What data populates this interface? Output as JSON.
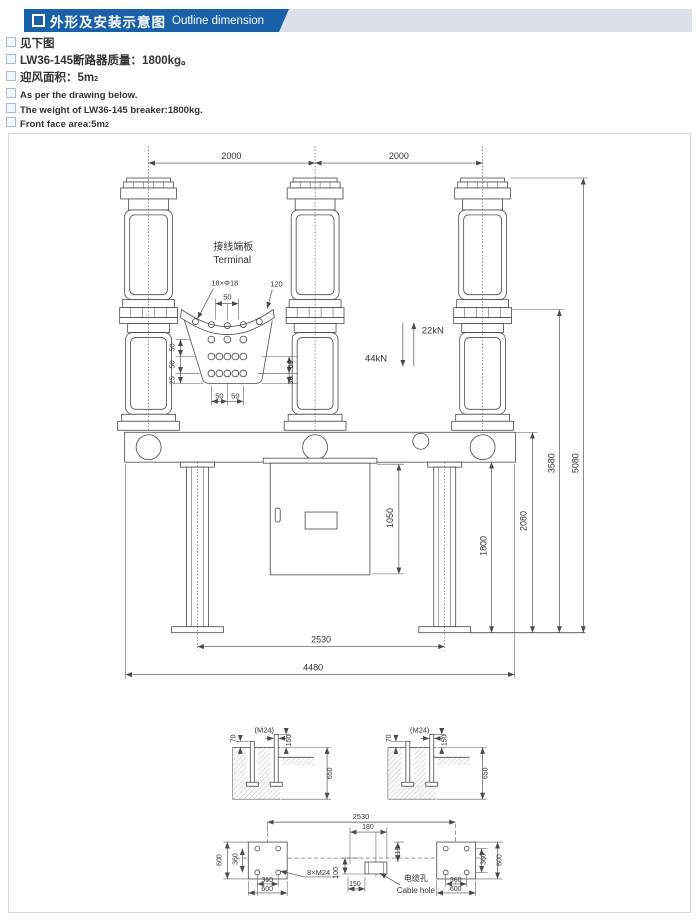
{
  "header": {
    "marker": "square-bullet",
    "title_zh": "外形及安装示意图",
    "title_en": "Outline dimension",
    "banner_color": "#1961a8",
    "band_color": "#dde2ea"
  },
  "bullets": [
    {
      "lang": "zh",
      "text": "见下图",
      "sup": ""
    },
    {
      "lang": "zh",
      "text": "LW36-145断路器质量：1800kg。",
      "sup": ""
    },
    {
      "lang": "zh",
      "text": "迎风面积：5m",
      "sup": "2"
    },
    {
      "lang": "en",
      "text": "As per the drawing below.",
      "sup": ""
    },
    {
      "lang": "en",
      "text": "The weight of LW36-145 breaker:1800kg.",
      "sup": ""
    },
    {
      "lang": "en",
      "text": "Front face area:5m",
      "sup": "2"
    }
  ],
  "drawing": {
    "line_color": "#4a4a4a",
    "labels": [
      {
        "name": "dim-2000-left",
        "text": "2000",
        "x": 223,
        "y": 25,
        "size": 9
      },
      {
        "name": "dim-2000-right",
        "text": "2000",
        "x": 391,
        "y": 25,
        "size": 9
      },
      {
        "name": "force-22kn",
        "text": "22kN",
        "x": 414,
        "y": 200,
        "anchor": "start",
        "size": 9.5
      },
      {
        "name": "force-44kn",
        "text": "44kN",
        "x": 357,
        "y": 228,
        "anchor": "start",
        "size": 9.5
      },
      {
        "name": "terminal-label-zh",
        "text": "接线端板",
        "x": 205,
        "y": 116,
        "anchor": "start",
        "size": 10
      },
      {
        "name": "terminal-label-en",
        "text": "Terminal",
        "x": 205,
        "y": 129,
        "anchor": "start",
        "size": 10
      },
      {
        "name": "terminal-holes-note",
        "text": "18×Φ18",
        "x": 203,
        "y": 152,
        "anchor": "start",
        "size": 7.5
      },
      {
        "name": "dim-120",
        "text": "120",
        "x": 262,
        "y": 153,
        "anchor": "start",
        "size": 7.5
      },
      {
        "name": "dim-term-top-50",
        "text": "50",
        "x": 219,
        "y": 166,
        "size": 7.5
      },
      {
        "name": "dim-term-left-50a",
        "text": "50",
        "x": 166,
        "y": 214,
        "rot": -90,
        "size": 7.5
      },
      {
        "name": "dim-term-left-50b",
        "text": "50",
        "x": 166,
        "y": 231,
        "rot": -90,
        "size": 7.5
      },
      {
        "name": "dim-term-left-25",
        "text": "25",
        "x": 166,
        "y": 247,
        "rot": -90,
        "size": 7.5
      },
      {
        "name": "dim-term-right-50",
        "text": "50",
        "x": 285,
        "y": 231,
        "rot": -90,
        "size": 7.5
      },
      {
        "name": "dim-term-right-30",
        "text": "30",
        "x": 285,
        "y": 247,
        "rot": -90,
        "size": 7.5
      },
      {
        "name": "dim-term-bottom-50a",
        "text": "50",
        "x": 211,
        "y": 265,
        "size": 7.5
      },
      {
        "name": "dim-term-bottom-50b",
        "text": "50",
        "x": 227,
        "y": 265,
        "size": 7.5
      },
      {
        "name": "dim-1050",
        "text": "1050",
        "x": 385,
        "y": 385,
        "rot": -90,
        "size": 9
      },
      {
        "name": "dim-1800",
        "text": "1800",
        "x": 479,
        "y": 413,
        "rot": -90,
        "size": 9
      },
      {
        "name": "dim-2080",
        "text": "2080",
        "x": 519,
        "y": 388,
        "rot": -90,
        "size": 9
      },
      {
        "name": "dim-3580",
        "text": "3580",
        "x": 547,
        "y": 330,
        "rot": -90,
        "size": 9
      },
      {
        "name": "dim-5080",
        "text": "5080",
        "x": 571,
        "y": 330,
        "rot": -90,
        "size": 9
      },
      {
        "name": "dim-2530-elev",
        "text": "2530",
        "x": 313,
        "y": 510,
        "size": 9
      },
      {
        "name": "dim-4480",
        "text": "4480",
        "x": 305,
        "y": 538,
        "size": 9
      },
      {
        "name": "dim-foundation-left-70",
        "text": "70",
        "x": 227,
        "y": 606,
        "rot": -90,
        "size": 7
      },
      {
        "name": "note-foundation-left-m24",
        "text": "(M24)",
        "x": 256,
        "y": 600,
        "size": 7.5
      },
      {
        "name": "dim-foundation-left-150",
        "text": "150",
        "x": 283,
        "y": 608,
        "rot": -90,
        "size": 7
      },
      {
        "name": "dim-foundation-left-650",
        "text": "650",
        "x": 324,
        "y": 641,
        "rot": -90,
        "size": 7
      },
      {
        "name": "dim-foundation-right-70",
        "text": "70",
        "x": 383,
        "y": 606,
        "rot": -90,
        "size": 7
      },
      {
        "name": "note-foundation-right-m24",
        "text": "(M24)",
        "x": 412,
        "y": 600,
        "size": 7.5
      },
      {
        "name": "dim-foundation-right-150",
        "text": "150",
        "x": 439,
        "y": 608,
        "rot": -90,
        "size": 7
      },
      {
        "name": "dim-foundation-right-650",
        "text": "650",
        "x": 480,
        "y": 641,
        "rot": -90,
        "size": 7
      },
      {
        "name": "dim-2530-plan",
        "text": "2530",
        "x": 353,
        "y": 687,
        "size": 7.5
      },
      {
        "name": "dim-cable-180",
        "text": "180",
        "x": 360,
        "y": 697,
        "size": 7
      },
      {
        "name": "dim-cable-115",
        "text": "115",
        "x": 392,
        "y": 720,
        "rot": -90,
        "size": 7
      },
      {
        "name": "dim-plate-left-600v",
        "text": "600",
        "x": 213,
        "y": 728,
        "rot": -90,
        "size": 7
      },
      {
        "name": "dim-plate-left-360v",
        "text": "360",
        "x": 229,
        "y": 727,
        "rot": -90,
        "size": 7
      },
      {
        "name": "dim-plate-left-360h",
        "text": "360",
        "x": 259,
        "y": 750,
        "size": 7
      },
      {
        "name": "dim-plate-left-600h",
        "text": "600",
        "x": 259,
        "y": 759,
        "size": 7
      },
      {
        "name": "note-anchor-bolts",
        "text": "8×M24",
        "x": 299,
        "y": 743,
        "anchor": "start",
        "size": 7.5
      },
      {
        "name": "dim-cable-100",
        "text": "100",
        "x": 330,
        "y": 741,
        "rot": -90,
        "size": 7
      },
      {
        "name": "dim-cable-150",
        "text": "150",
        "x": 347,
        "y": 754,
        "size": 7
      },
      {
        "name": "cable-hole-label-zh",
        "text": "电缆孔",
        "x": 396,
        "y": 749,
        "anchor": "start",
        "size": 8
      },
      {
        "name": "cable-hole-label-en",
        "text": "Cable hole",
        "x": 389,
        "y": 761,
        "anchor": "start",
        "size": 8
      },
      {
        "name": "dim-plate-right-360v",
        "text": "360",
        "x": 478,
        "y": 727,
        "rot": -90,
        "size": 7
      },
      {
        "name": "dim-plate-right-600v",
        "text": "600",
        "x": 494,
        "y": 728,
        "rot": -90,
        "size": 7
      },
      {
        "name": "dim-plate-right-360h",
        "text": "360",
        "x": 448,
        "y": 750,
        "size": 7
      },
      {
        "name": "dim-plate-right-600h",
        "text": "600",
        "x": 448,
        "y": 759,
        "size": 7
      }
    ]
  }
}
